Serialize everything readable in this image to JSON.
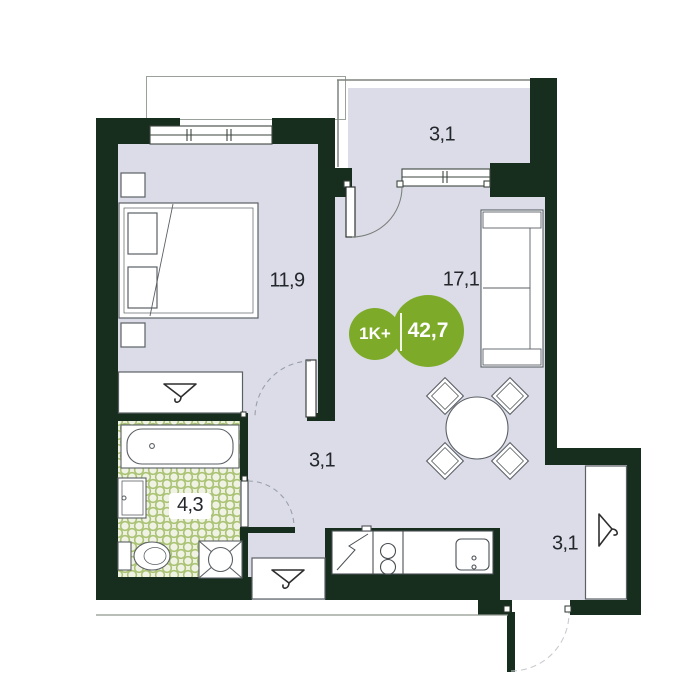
{
  "plan": {
    "badge": {
      "type_label": "1K+",
      "area_label": "42,7"
    },
    "rooms": [
      {
        "id": "bedroom",
        "area_label": "11,9"
      },
      {
        "id": "loggia",
        "area_label": "3,1"
      },
      {
        "id": "kitchen-living",
        "area_label": "17,1"
      },
      {
        "id": "hallway",
        "area_label": "3,1"
      },
      {
        "id": "bathroom",
        "area_label": "4,3"
      },
      {
        "id": "entry",
        "area_label": "3,1"
      }
    ],
    "colors": {
      "wall": "#172d1e",
      "floor": "#dbdce8",
      "accent": "#7dab29",
      "bath-floor": "#f0f3e3",
      "bath-dot": "#a9c273",
      "line": "#5b6065"
    },
    "icons": [
      "hanger-icon",
      "bed-icon",
      "nightstand-icon",
      "sofa-icon",
      "table-chairs-icon",
      "bathtub-icon",
      "wash-basin-icon",
      "toilet-icon",
      "washing-machine-icon",
      "fridge-icon",
      "stove-icon",
      "kitchen-sink-icon",
      "door-arc-icon",
      "window-icon"
    ]
  }
}
